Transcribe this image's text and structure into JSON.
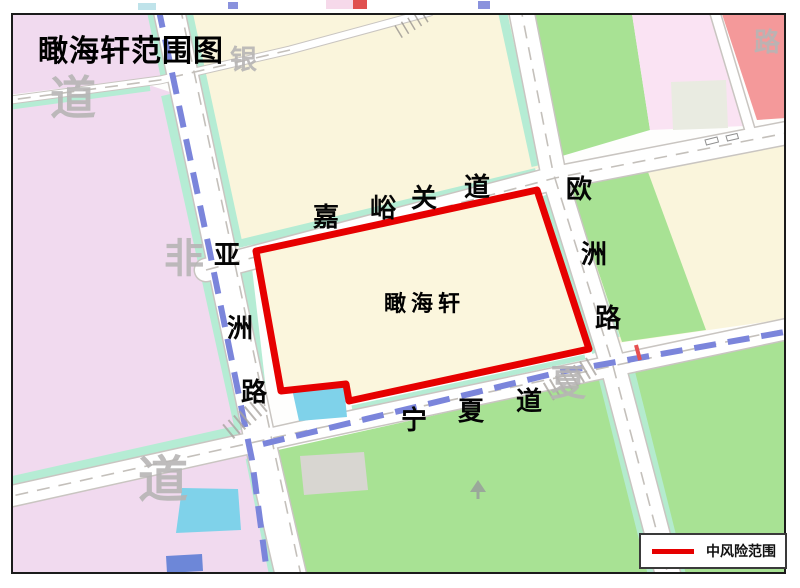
{
  "title": "瞰海轩范围图",
  "area_label": "瞰海轩",
  "roads": {
    "jiayuguan": {
      "name": "嘉峪关道",
      "chars": [
        "嘉",
        "峪",
        "关",
        "道"
      ]
    },
    "ningxia": {
      "name": "宁夏道",
      "chars": [
        "宁",
        "夏",
        "道"
      ]
    },
    "yazhou": {
      "name": "亚洲路",
      "chars": [
        "亚",
        "洲",
        "路"
      ]
    },
    "ouzhou": {
      "name": "欧洲路",
      "chars": [
        "欧",
        "洲",
        "路"
      ]
    }
  },
  "faded_labels": {
    "top_left_dao": "道",
    "yin": "银",
    "fei": "非",
    "bottom_left_dao": "道",
    "xia": "夏",
    "top_right_lu": "路"
  },
  "legend": {
    "label": "中风险范围",
    "line_color": "#e60000"
  },
  "colors": {
    "risk_outline": "#e60000",
    "parcel_cream": "#faf5dc",
    "parcel_pink": "#f1daef",
    "parcel_green": "#a8e294",
    "parcel_salmon": "#f4999a",
    "parcel_lightpink": "#fae3f3",
    "water_cyan": "#7fd2ea",
    "greenbelt_teal": "#b5ecd4",
    "metro_blue": "#7b85db"
  }
}
